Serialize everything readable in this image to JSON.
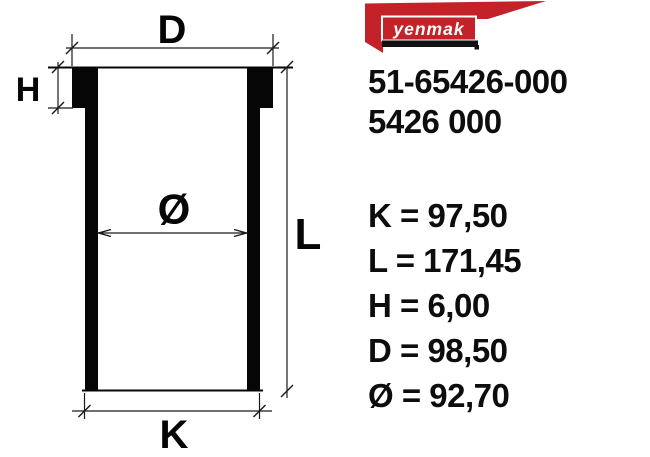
{
  "page": {
    "background": "#ffffff",
    "accent_red": "#c32228",
    "text_color": "#0d0d0d"
  },
  "logo": {
    "brand": "yenmak"
  },
  "part_numbers": {
    "primary": "51-65426-000",
    "secondary": "5426 000"
  },
  "drawing": {
    "kind": "cylinder-liner-cross-section",
    "labels": {
      "flange_outer_diameter": "D",
      "flange_height": "H",
      "bore_diameter": "Ø",
      "total_length": "L",
      "body_outer_diameter": "K"
    }
  },
  "specs": [
    {
      "name": "K",
      "value": "97,50",
      "text": "K = 97,50"
    },
    {
      "name": "L",
      "value": "171,45",
      "text": "L = 171,45"
    },
    {
      "name": "H",
      "value": "6,00",
      "text": "H = 6,00"
    },
    {
      "name": "D",
      "value": "98,50",
      "text": "D = 98,50"
    },
    {
      "name": "Ø",
      "value": "92,70",
      "text": "Ø = 92,70"
    }
  ]
}
